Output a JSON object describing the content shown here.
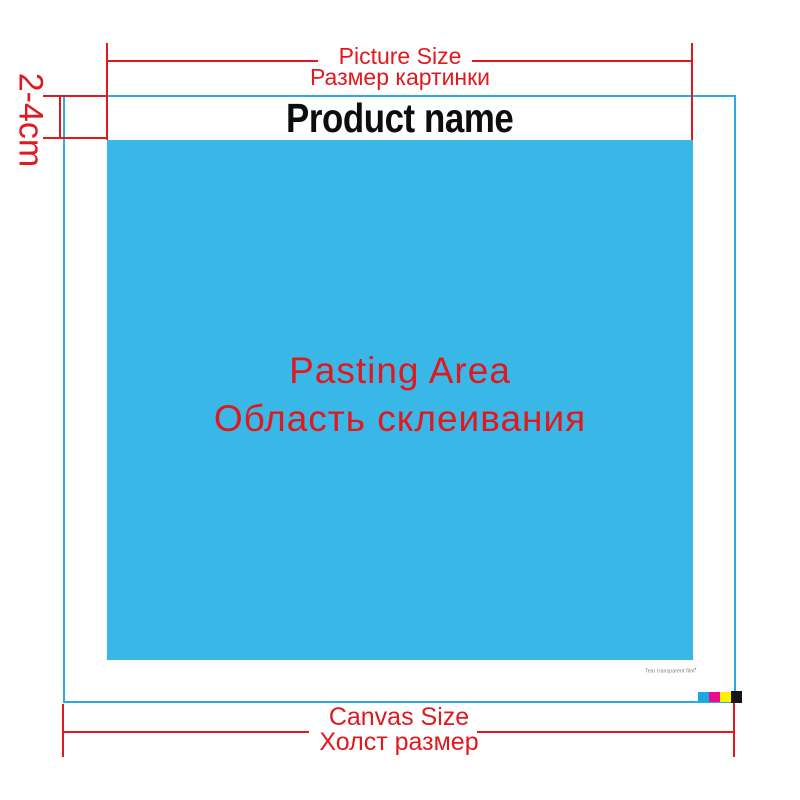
{
  "colors": {
    "red": "#e0191e",
    "canvas_border": "#2aabe2",
    "pasting_fill": "#39b7e6",
    "product_text": "#0d0d0d",
    "swatch_cyan": "#19a8e0",
    "swatch_magenta": "#ec0b8b",
    "swatch_yellow": "#fff200",
    "swatch_black": "#161616",
    "fine_print_gray": "#777777"
  },
  "top_measure": {
    "label_en": "Picture Size",
    "label_ru": "Размер картинки"
  },
  "left_measure": {
    "label": "2-4cm"
  },
  "bottom_measure": {
    "label_en": "Canvas Size",
    "label_ru": "Холст размер"
  },
  "product": {
    "name": "Product name"
  },
  "pasting_area": {
    "label_en": "Pasting Area",
    "label_ru": "Область склеивания"
  },
  "fine_print": {
    "text": "Tear transparent film",
    "mark": "▪"
  },
  "swatches": {
    "cyan": "cyan-swatch",
    "magenta": "magenta-swatch",
    "yellow": "yellow-swatch",
    "black": "black-swatch"
  }
}
